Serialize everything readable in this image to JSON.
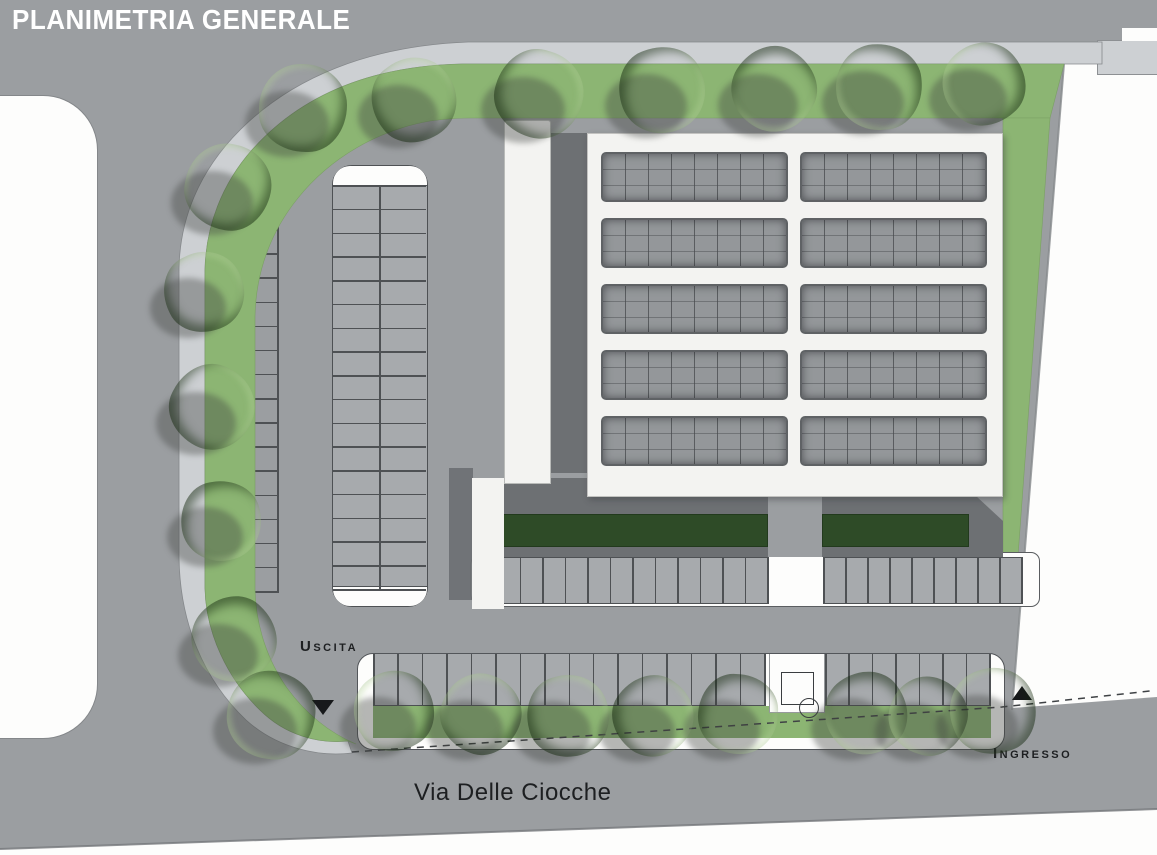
{
  "title": "PLANIMETRIA GENERALE",
  "labels": {
    "exit": "Uscita",
    "entrance": "Ingresso",
    "street": "Via Delle Ciocche"
  },
  "icons": {
    "exit_arrow": "down-triangle-icon",
    "entrance_arrow": "up-triangle-icon",
    "pad_marker": "circle-in-square-icon"
  },
  "colors": {
    "road": "#9b9ea1",
    "pavement": "#a7aaad",
    "sidewalk": "#cdd0d3",
    "grass": "#8cb573",
    "hedge": "#2e4b27",
    "building_roof": "#f3f3f1",
    "building_wall": "#6d7073",
    "skylight": "#94979a",
    "line": "#4e5154",
    "label": "#1d1f21",
    "white": "#fdfdfc"
  },
  "site": {
    "building": {
      "skylight_cols": 2,
      "skylight_rows": 5
    },
    "parking": {
      "west_column_stalls": 17,
      "island_rows": 17,
      "north_row_left_stalls": 12,
      "north_row_right_stalls": 9,
      "south_left_stalls": 16,
      "south_right_stalls": 7
    },
    "trees": [
      {
        "x": 303,
        "y": 108,
        "r": 44
      },
      {
        "x": 414,
        "y": 100,
        "r": 42
      },
      {
        "x": 539,
        "y": 94,
        "r": 44
      },
      {
        "x": 662,
        "y": 90,
        "r": 43
      },
      {
        "x": 774,
        "y": 89,
        "r": 42
      },
      {
        "x": 879,
        "y": 87,
        "r": 43
      },
      {
        "x": 984,
        "y": 84,
        "r": 41
      },
      {
        "x": 228,
        "y": 187,
        "r": 43
      },
      {
        "x": 204,
        "y": 292,
        "r": 40
      },
      {
        "x": 212,
        "y": 407,
        "r": 42
      },
      {
        "x": 221,
        "y": 521,
        "r": 40
      },
      {
        "x": 234,
        "y": 639,
        "r": 42
      },
      {
        "x": 271,
        "y": 715,
        "r": 44
      },
      {
        "x": 394,
        "y": 711,
        "r": 40
      },
      {
        "x": 481,
        "y": 714,
        "r": 40
      },
      {
        "x": 568,
        "y": 716,
        "r": 41
      },
      {
        "x": 653,
        "y": 716,
        "r": 40
      },
      {
        "x": 738,
        "y": 714,
        "r": 40
      },
      {
        "x": 866,
        "y": 713,
        "r": 41
      },
      {
        "x": 928,
        "y": 716,
        "r": 39
      },
      {
        "x": 993,
        "y": 711,
        "r": 43
      }
    ]
  }
}
